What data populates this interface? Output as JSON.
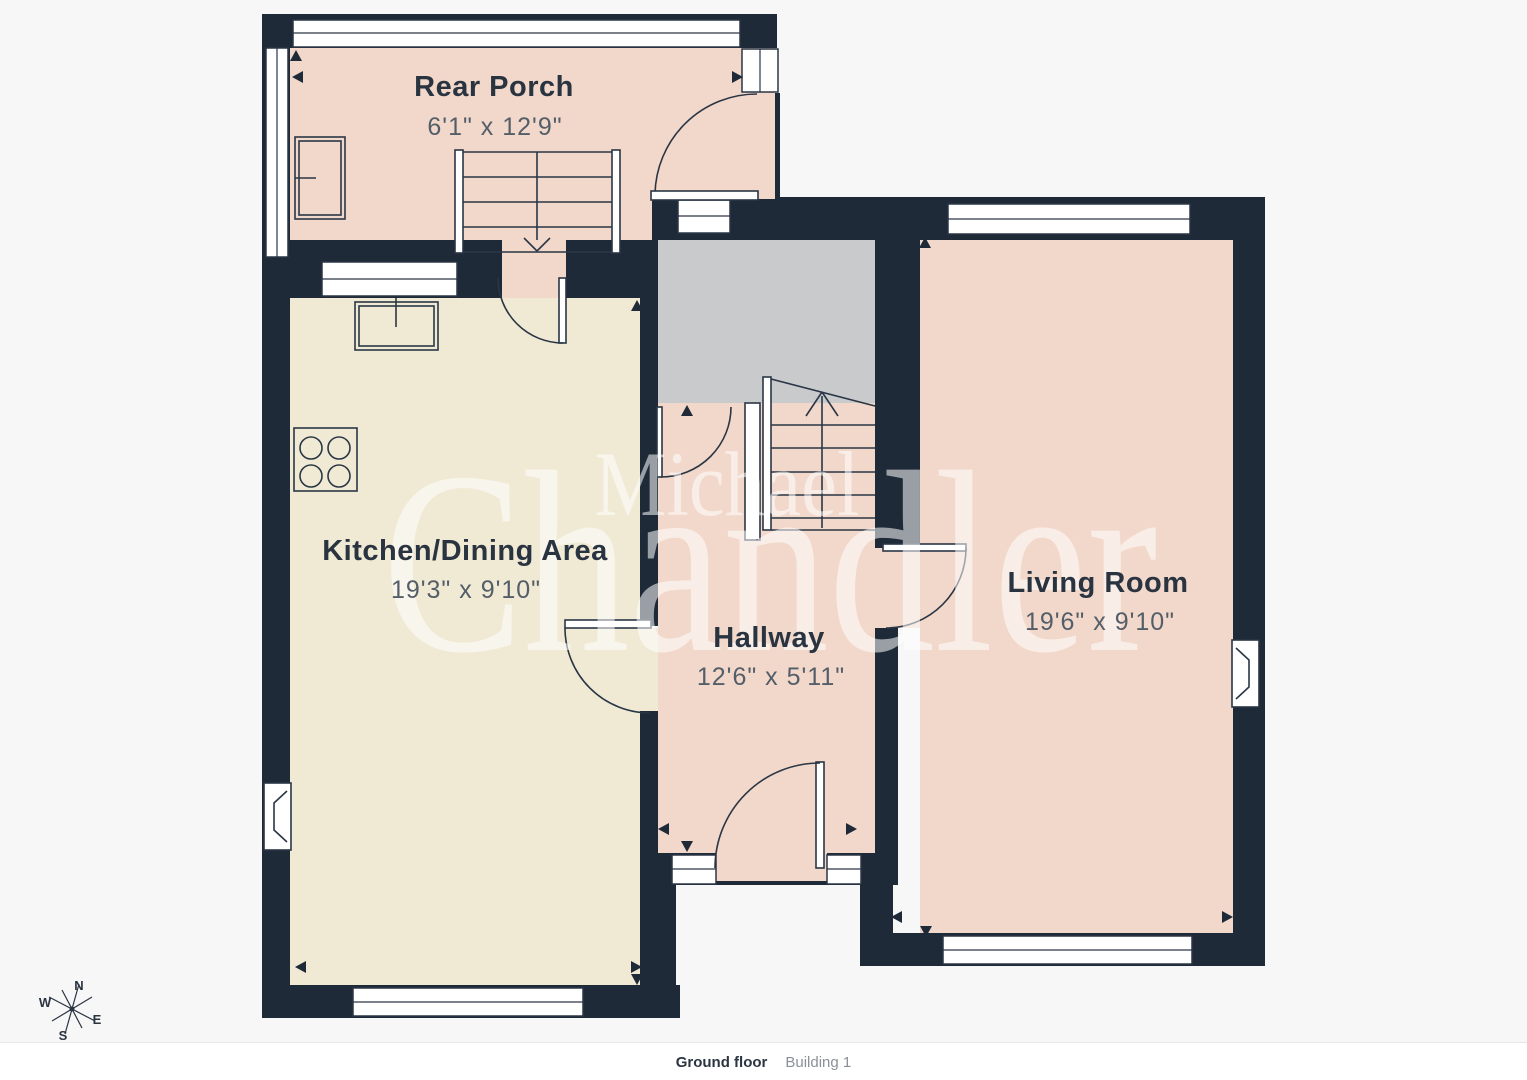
{
  "meta": {
    "floor_label": "Ground floor",
    "building_label": "Building 1"
  },
  "rooms": [
    {
      "id": "rear-porch",
      "name": "Rear Porch",
      "dimensions": "6'1\" x 12'9\""
    },
    {
      "id": "kitchen-dining",
      "name": "Kitchen/Dining Area",
      "dimensions": "19'3\" x 9'10\""
    },
    {
      "id": "hallway",
      "name": "Hallway",
      "dimensions": "12'6\" x 5'11\""
    },
    {
      "id": "living-room",
      "name": "Living Room",
      "dimensions": "19'6\" x 9'10\""
    }
  ],
  "watermark": {
    "line1": "Michael",
    "line2": "Chandler"
  },
  "compass": {
    "n": "N",
    "e": "E",
    "s": "S",
    "w": "W"
  },
  "colors": {
    "wall": "#1e2a38",
    "porch_fill": "#f2d8ca",
    "kitchen_fill": "#f0ead5",
    "hall_fill": "#f2d8ca",
    "living_fill": "#f2d8ca",
    "cupboard_gray": "#c9cacc",
    "background": "#f7f7f8"
  }
}
